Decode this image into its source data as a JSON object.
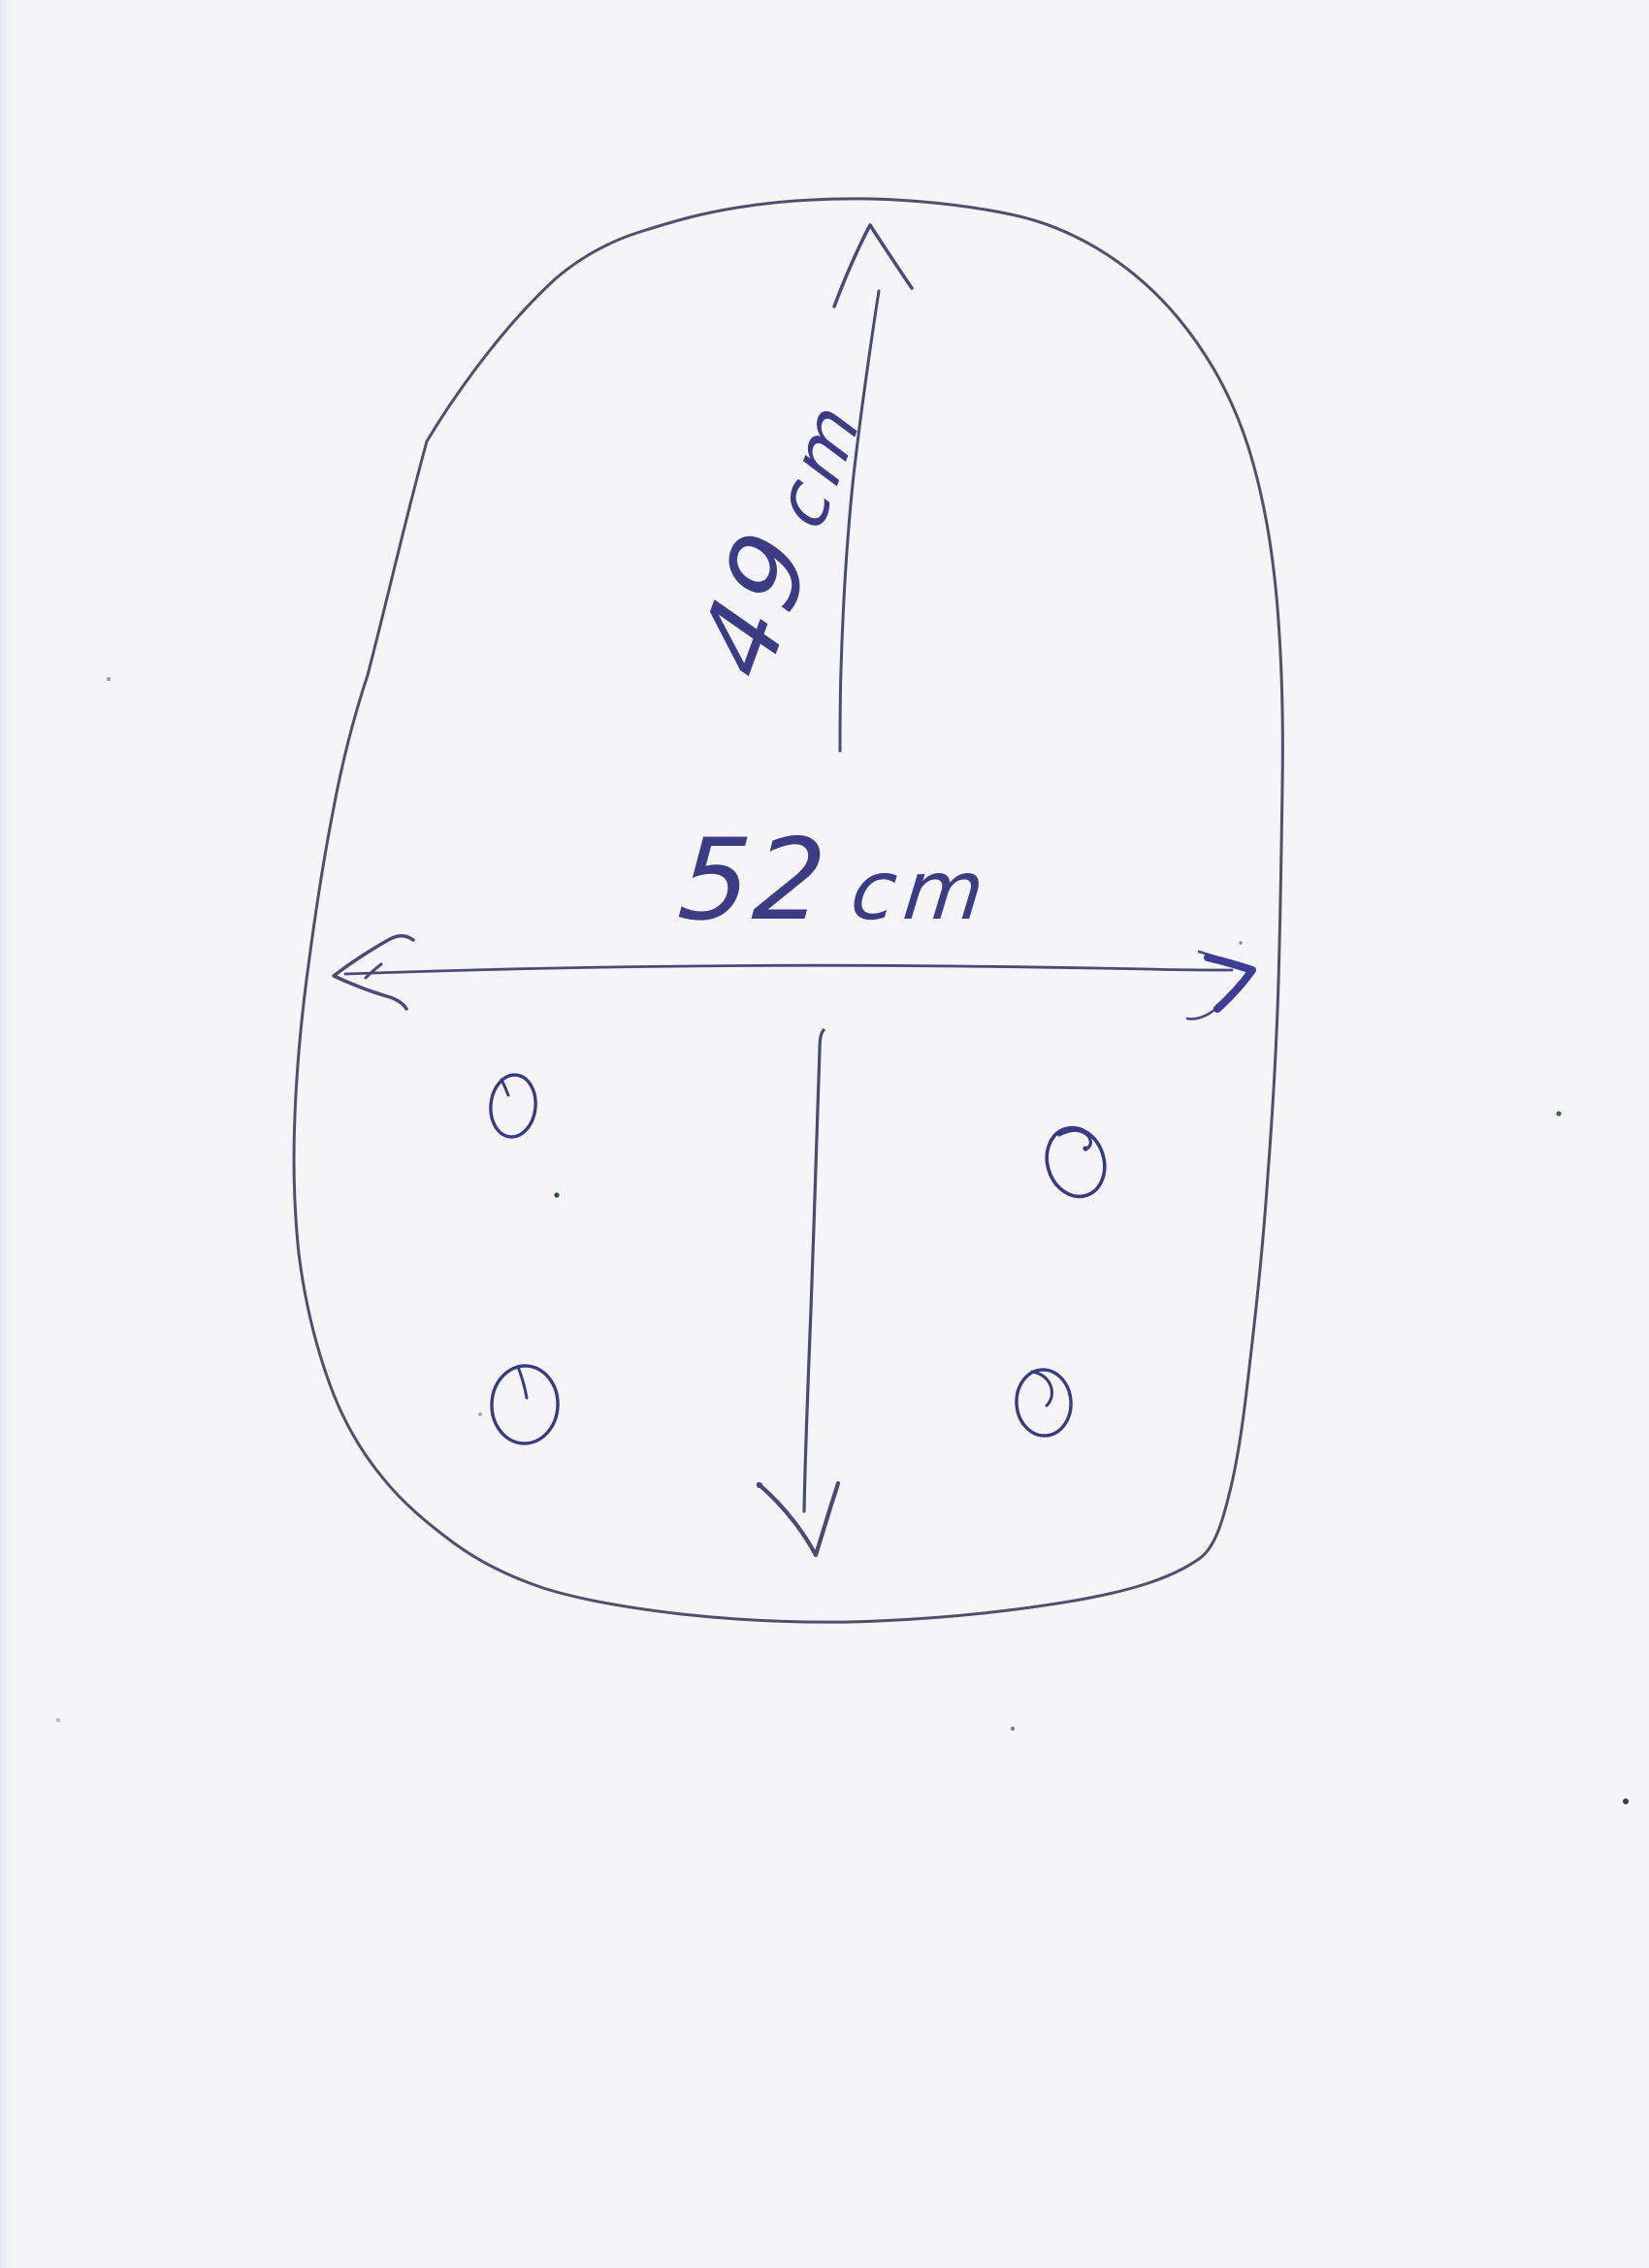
{
  "paper": {
    "background_color": "#f5f5f8",
    "edge_strip_color": "#e6e8ee"
  },
  "ink": {
    "line_color": "#4a4a74",
    "outline_color": "#50506e",
    "bold_color": "#3d3d96",
    "circle_color": "#3a3a80",
    "text_color": "#3c3c85"
  },
  "sketch": {
    "dimensions": {
      "vertical": {
        "number": "49",
        "unit": "cm",
        "label": "49cm"
      },
      "horizontal": {
        "number": "52",
        "unit": "cm",
        "label": "52cm"
      }
    },
    "holes": {
      "count": "4"
    }
  }
}
